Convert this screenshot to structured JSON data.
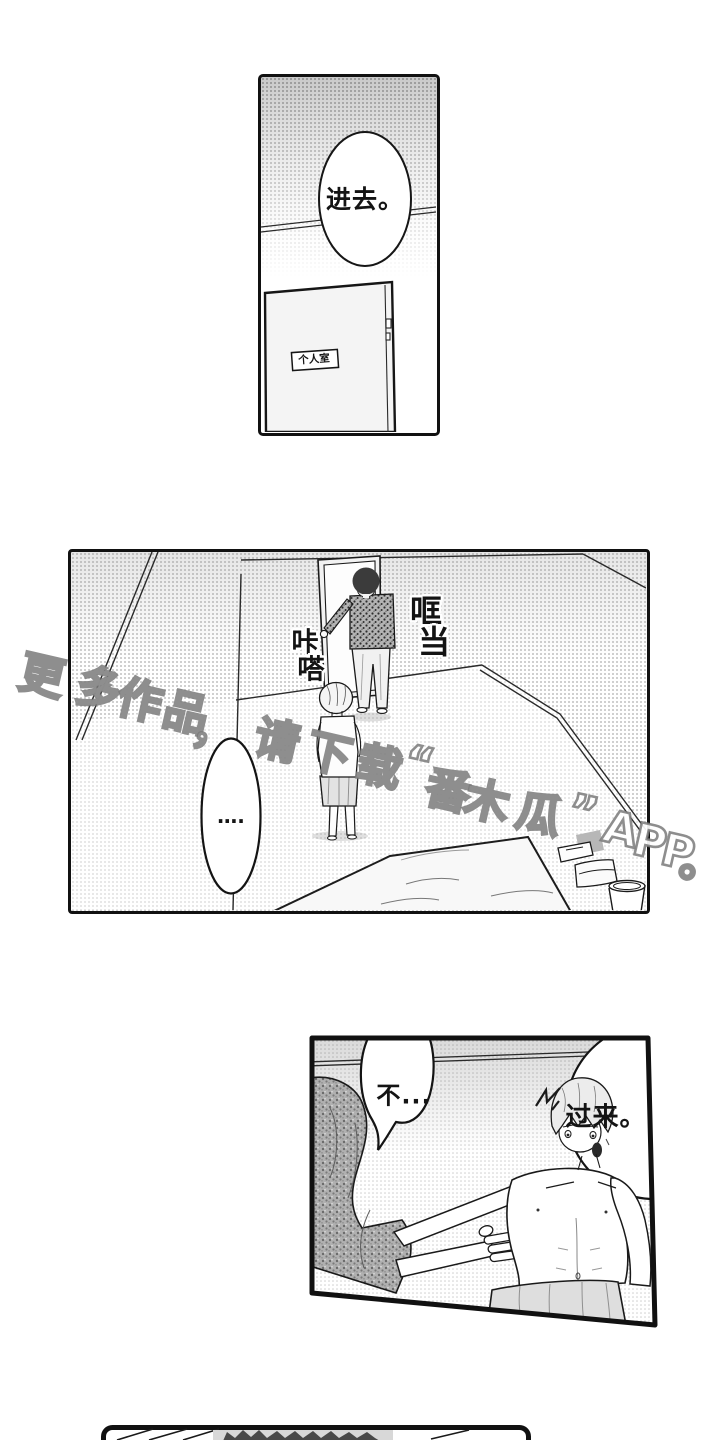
{
  "panel1": {
    "bubble_text": "进去。",
    "door_sign": "个人室"
  },
  "panel2": {
    "sfx_click": {
      "chars": [
        "咔",
        "嗒"
      ]
    },
    "sfx_clang": {
      "chars": [
        "哐",
        "当"
      ]
    },
    "bubble_text": "…."
  },
  "panel3": {
    "bubble_no": "不...",
    "bubble_come": "过来。"
  },
  "watermark": {
    "text": "更多作品，请下载“番木瓜”APP。"
  },
  "colors": {
    "ink": "#141414",
    "tone_gray": "#c9c9c9",
    "towel_gray": "#dedede",
    "dark_cloth": "#a8a8a8",
    "watermark_stroke": "#7a7a7a"
  }
}
